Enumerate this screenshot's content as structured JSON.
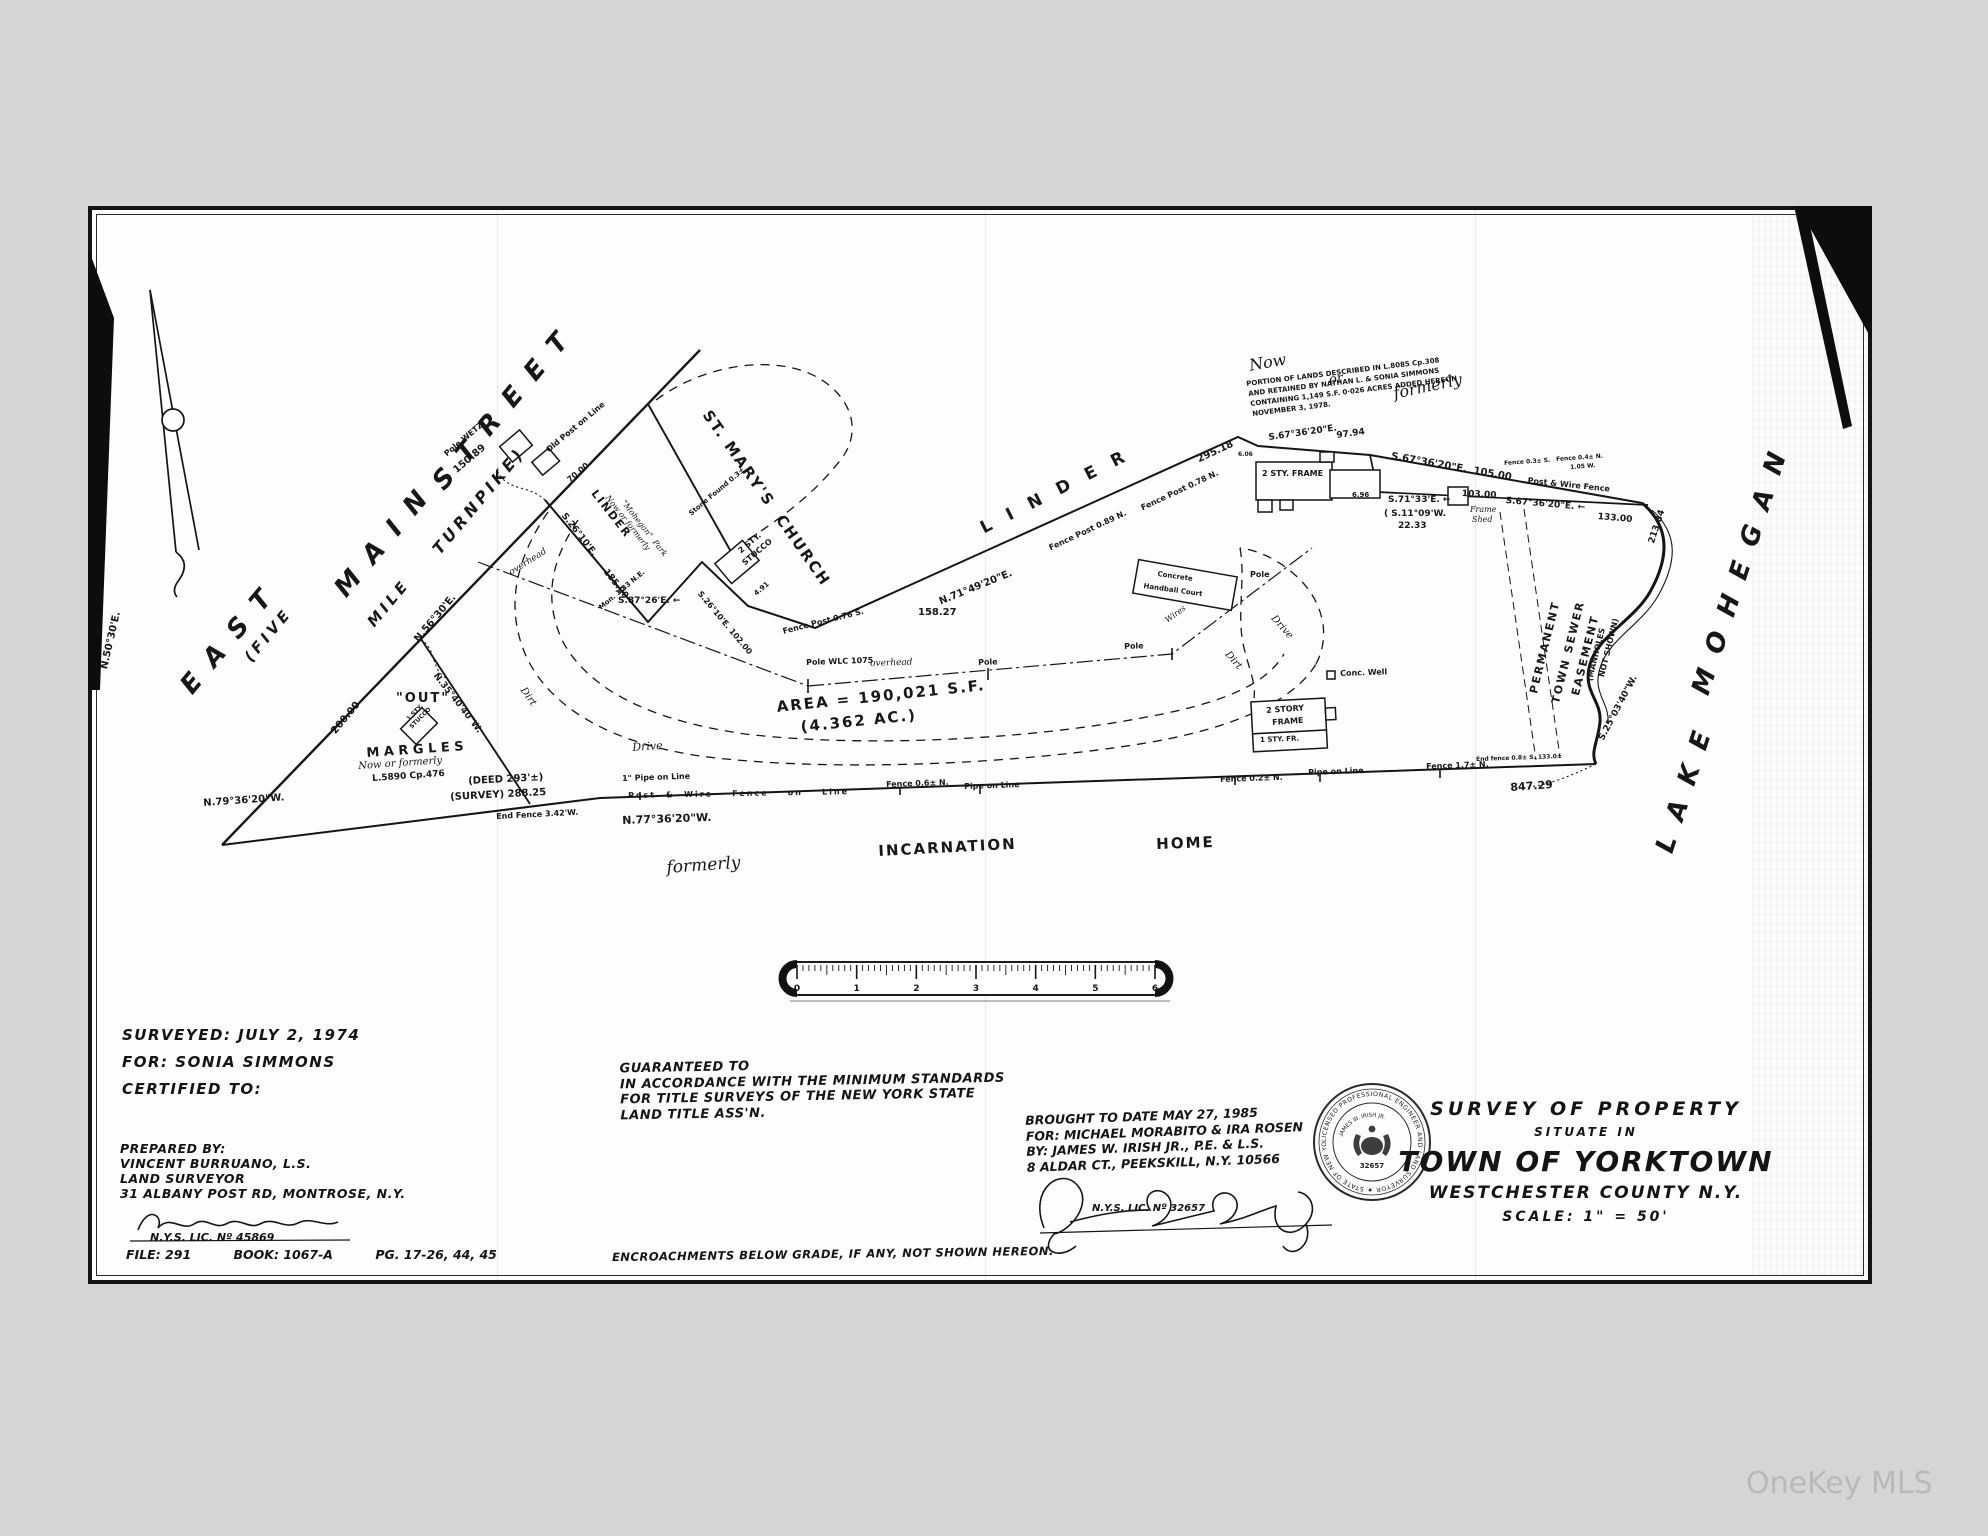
{
  "watermark": "OneKey MLS",
  "title_block": {
    "survey_of_property": "SURVEY OF PROPERTY",
    "situate_in": "SITUATE IN",
    "town": "TOWN OF YORKTOWN",
    "county": "WESTCHESTER COUNTY N.Y.",
    "scale": "SCALE: 1\" = 50'"
  },
  "surveyor_block": {
    "lines": [
      "SURVEYED:   JULY 2, 1974",
      "FOR:   SONIA SIMMONS",
      "CERTIFIED TO:"
    ],
    "prepared_lines": [
      "PREPARED BY:",
      "VINCENT BURRUANO, L.S.",
      "LAND   SURVEYOR",
      "31 ALBANY POST RD, MONTROSE, N.Y."
    ],
    "license": "N.Y.S. LIC. Nº 45869",
    "signature_name": "Vincent Burruano"
  },
  "file_block": {
    "file": "FILE: 291",
    "book": "BOOK: 1067-A",
    "pages": "PG. 17-26, 44, 45"
  },
  "guarantee_block": {
    "lines": [
      "GUARANTEED TO",
      "IN ACCORDANCE WITH THE MINIMUM STANDARDS",
      "FOR TITLE SURVEYS OF THE NEW YORK STATE",
      "LAND TITLE ASS'N."
    ]
  },
  "revision_block": {
    "lines": [
      "BROUGHT TO DATE  MAY 27, 1985",
      "FOR:  MICHAEL MORABITO & IRA ROSEN",
      "BY: JAMES W. IRISH JR., P.E. & L.S.",
      "8 ALDAR CT., PEEKSKILL, N.Y. 10566"
    ],
    "license": "N.Y.S. LIC. Nº 32657",
    "signature_name": "James W. Irish Jr."
  },
  "encroachment_note": "ENCROACHMENTS BELOW GRADE, IF ANY, NOT SHOWN HEREON.",
  "seal": {
    "ring_text": "LICENSED PROFESSIONAL ENGINEER AND LAND SURVEYOR ★ STATE OF NEW YORK ★",
    "name": "JAMES W. IRISH JR.",
    "number": "32657"
  },
  "ruler": {
    "numbers": [
      "0",
      "1",
      "2",
      "3",
      "4",
      "5",
      "6"
    ]
  },
  "map": {
    "area_label": "AREA = 190,021 S.F. (4.362 AC.)",
    "labels": [
      {
        "t": "E A S T",
        "x": 176,
        "y": 682,
        "r": -50,
        "s": 26,
        "cls": "bg"
      },
      {
        "t": "M A I N",
        "x": 330,
        "y": 585,
        "r": -50,
        "s": 26,
        "cls": "bg"
      },
      {
        "t": "S T R E E T",
        "x": 428,
        "y": 478,
        "r": -50,
        "s": 26,
        "cls": "bg"
      },
      {
        "t": "(FIVE",
        "x": 242,
        "y": 655,
        "r": -50,
        "s": 15,
        "cls": "bg"
      },
      {
        "t": "MILE",
        "x": 365,
        "y": 620,
        "r": -50,
        "s": 15,
        "cls": "bg"
      },
      {
        "t": "TURNPIKE)",
        "x": 430,
        "y": 547,
        "r": -50,
        "s": 16,
        "cls": "bg"
      },
      {
        "t": "N.50°30'E.",
        "x": 100,
        "y": 668,
        "r": -77,
        "s": 10
      },
      {
        "t": "200.00",
        "x": 330,
        "y": 730,
        "r": -50,
        "s": 10
      },
      {
        "t": "N.56°30'E.",
        "x": 413,
        "y": 638,
        "r": -50,
        "s": 10
      },
      {
        "t": "N.35°40'40\"W.",
        "x": 438,
        "y": 672,
        "r": 52,
        "s": 9
      },
      {
        "t": "Pole WETZ",
        "x": 443,
        "y": 452,
        "r": -40,
        "s": 8
      },
      {
        "t": "150.89",
        "x": 452,
        "y": 468,
        "r": -40,
        "s": 10
      },
      {
        "t": "Old Post on Line",
        "x": 545,
        "y": 448,
        "r": -40,
        "s": 8
      },
      {
        "t": "70.00",
        "x": 566,
        "y": 478,
        "r": -40,
        "s": 8
      },
      {
        "t": "ST. MARY'S  CHURCH",
        "x": 712,
        "y": 408,
        "r": 55,
        "s": 15,
        "cls": "sp"
      },
      {
        "t": "L  I  N  D  E  R",
        "x": 978,
        "y": 522,
        "r": -27,
        "s": 17,
        "cls": "sp"
      },
      {
        "t": "LINDER",
        "x": 598,
        "y": 488,
        "r": 52,
        "s": 11,
        "cls": "sp"
      },
      {
        "t": "Now or formerly",
        "x": 610,
        "y": 494,
        "r": 52,
        "s": 8,
        "cls": "it"
      },
      {
        "t": "\"Mohegan\"  Park",
        "x": 626,
        "y": 499,
        "r": 52,
        "s": 8,
        "cls": "it"
      },
      {
        "t": "S.26°10'E.",
        "x": 566,
        "y": 512,
        "r": 52,
        "s": 9
      },
      {
        "t": "185.00",
        "x": 608,
        "y": 568,
        "r": 52,
        "s": 9
      },
      {
        "t": "Mon. 1.33 N.E.",
        "x": 598,
        "y": 606,
        "r": -40,
        "s": 7
      },
      {
        "t": "S.87°26'E. ←",
        "x": 618,
        "y": 597,
        "r": 0,
        "s": 9
      },
      {
        "t": "Stone Found 0.3±",
        "x": 688,
        "y": 512,
        "r": -40,
        "s": 7
      },
      {
        "t": "2 STY.",
        "x": 737,
        "y": 549,
        "r": -40,
        "s": 8
      },
      {
        "t": "STUCCO",
        "x": 741,
        "y": 561,
        "r": -40,
        "s": 8
      },
      {
        "t": "4.91",
        "x": 753,
        "y": 592,
        "r": -40,
        "s": 7
      },
      {
        "t": "S.26°10'E. 102.00",
        "x": 702,
        "y": 590,
        "r": 50,
        "s": 8
      },
      {
        "t": "Fence Post 0.76 S.",
        "x": 782,
        "y": 628,
        "r": -14,
        "s": 8
      },
      {
        "t": "158.27",
        "x": 918,
        "y": 608,
        "r": 0,
        "s": 10
      },
      {
        "t": "N.71°49'20\"E.",
        "x": 938,
        "y": 598,
        "r": -22,
        "s": 10
      },
      {
        "t": "Fence Post 0.89 N.",
        "x": 1048,
        "y": 545,
        "r": -25,
        "s": 8
      },
      {
        "t": "Fence Post 0.78 N.",
        "x": 1140,
        "y": 505,
        "r": -25,
        "s": 8
      },
      {
        "t": "295.18",
        "x": 1196,
        "y": 456,
        "r": -25,
        "s": 10
      },
      {
        "t": "Now",
        "x": 1248,
        "y": 358,
        "r": -10,
        "s": 16,
        "cls": "it"
      },
      {
        "t": "or",
        "x": 1328,
        "y": 374,
        "r": -10,
        "s": 13,
        "cls": "it"
      },
      {
        "t": "formerly",
        "x": 1392,
        "y": 386,
        "r": -12,
        "s": 16,
        "cls": "it"
      },
      {
        "t": "PORTION OF LANDS DESCRIBED IN L.8085 Cp.308",
        "x": 1246,
        "y": 381,
        "r": -7,
        "s": 7
      },
      {
        "t": "AND RETAINED BY NATHAN L. & SONIA SIMMONS",
        "x": 1248,
        "y": 391,
        "r": -7,
        "s": 7
      },
      {
        "t": "CONTAINING 1,149 S.F. 0·026 ACRES ADDED HEREON",
        "x": 1250,
        "y": 401,
        "r": -7,
        "s": 7
      },
      {
        "t": "NOVEMBER 3, 1978.",
        "x": 1252,
        "y": 411,
        "r": -7,
        "s": 7
      },
      {
        "t": "S.67°36'20\"E.",
        "x": 1268,
        "y": 434,
        "r": -8,
        "s": 9
      },
      {
        "t": "97.94",
        "x": 1336,
        "y": 432,
        "r": -8,
        "s": 9
      },
      {
        "t": "6.06",
        "x": 1238,
        "y": 452,
        "r": 0,
        "s": 6
      },
      {
        "t": "S.67°36'20\"E.  105.00",
        "x": 1392,
        "y": 452,
        "r": 10,
        "s": 10
      },
      {
        "t": "2 STY. FRAME",
        "x": 1262,
        "y": 470,
        "r": 0,
        "s": 8
      },
      {
        "t": "6.96",
        "x": 1352,
        "y": 492,
        "r": 0,
        "s": 7
      },
      {
        "t": "S.71°33'E. ←",
        "x": 1388,
        "y": 496,
        "r": 0,
        "s": 9
      },
      {
        "t": "( S.11°09'W.",
        "x": 1384,
        "y": 510,
        "r": 0,
        "s": 9
      },
      {
        "t": "22.33",
        "x": 1398,
        "y": 522,
        "r": 0,
        "s": 9
      },
      {
        "t": "103.00",
        "x": 1462,
        "y": 490,
        "r": 3,
        "s": 9
      },
      {
        "t": "Frame",
        "x": 1470,
        "y": 506,
        "r": 0,
        "s": 8,
        "cls": "it"
      },
      {
        "t": "Shed",
        "x": 1472,
        "y": 516,
        "r": 0,
        "s": 8,
        "cls": "it"
      },
      {
        "t": "Fence 0.3± S.",
        "x": 1504,
        "y": 461,
        "r": -4,
        "s": 6
      },
      {
        "t": "Fence 0.4± N.",
        "x": 1556,
        "y": 457,
        "r": -4,
        "s": 6
      },
      {
        "t": "1.05 W.",
        "x": 1570,
        "y": 465,
        "r": -4,
        "s": 6
      },
      {
        "t": "Post & Wire Fence",
        "x": 1528,
        "y": 477,
        "r": 6,
        "s": 8
      },
      {
        "t": "S.67°36'20\"E. ←",
        "x": 1506,
        "y": 497,
        "r": 5,
        "s": 9
      },
      {
        "t": "133.00",
        "x": 1598,
        "y": 513,
        "r": 5,
        "s": 9
      },
      {
        "t": "213.84",
        "x": 1648,
        "y": 542,
        "r": -72,
        "s": 9
      },
      {
        "t": "S.25°03'40\"W.",
        "x": 1598,
        "y": 738,
        "r": -62,
        "s": 9
      },
      {
        "t": "PERMANENT",
        "x": 1528,
        "y": 692,
        "r": -76,
        "s": 11,
        "cls": "sp"
      },
      {
        "t": "TOWN SEWER",
        "x": 1550,
        "y": 702,
        "r": -76,
        "s": 11,
        "cls": "sp"
      },
      {
        "t": "EASEMENT",
        "x": 1570,
        "y": 694,
        "r": -76,
        "s": 11,
        "cls": "sp"
      },
      {
        "t": "(MANHOLES",
        "x": 1586,
        "y": 680,
        "r": -76,
        "s": 8
      },
      {
        "t": "NOT SHOWN)",
        "x": 1598,
        "y": 676,
        "r": -76,
        "s": 8
      },
      {
        "t": "L A K E",
        "x": 1652,
        "y": 848,
        "r": -72,
        "s": 26,
        "cls": "bg"
      },
      {
        "t": "M O H E G A N",
        "x": 1688,
        "y": 690,
        "r": -72,
        "s": 26,
        "cls": "bg"
      },
      {
        "t": "End fence 0.8± S. 133.0±",
        "x": 1476,
        "y": 757,
        "r": -2,
        "s": 6
      },
      {
        "t": "847.29",
        "x": 1510,
        "y": 782,
        "r": -4,
        "s": 11
      },
      {
        "t": "Fence 1.7± N.",
        "x": 1426,
        "y": 763,
        "r": -2,
        "s": 8
      },
      {
        "t": "Pipe on Line",
        "x": 1308,
        "y": 769,
        "r": -2,
        "s": 8
      },
      {
        "t": "Fence 0.2± N.",
        "x": 1220,
        "y": 776,
        "r": -2,
        "s": 8
      },
      {
        "t": "Pipe on Line",
        "x": 964,
        "y": 783,
        "r": -2,
        "s": 8
      },
      {
        "t": "Fence 0.6± N.",
        "x": 886,
        "y": 781,
        "r": -2,
        "s": 8
      },
      {
        "t": "1\" Pipe on Line",
        "x": 622,
        "y": 775,
        "r": -2,
        "s": 8
      },
      {
        "t": "Post  &  Wire    Fence    on    Line",
        "x": 628,
        "y": 792,
        "r": -1,
        "s": 8,
        "cls": "sp"
      },
      {
        "t": "N.77°36'20\"W.",
        "x": 622,
        "y": 815,
        "r": -2,
        "s": 11
      },
      {
        "t": "N.79°36'20\"W.",
        "x": 203,
        "y": 799,
        "r": -4,
        "s": 10
      },
      {
        "t": "(DEED 293'±)",
        "x": 468,
        "y": 777,
        "r": -3,
        "s": 10
      },
      {
        "t": "(SURVEY) 288.25",
        "x": 450,
        "y": 793,
        "r": -3,
        "s": 10
      },
      {
        "t": "End Fence 3.42'W.",
        "x": 496,
        "y": 813,
        "r": -3,
        "s": 8
      },
      {
        "t": "\"OUT\"",
        "x": 396,
        "y": 692,
        "r": 0,
        "s": 13,
        "cls": "sp"
      },
      {
        "t": "1 STY.",
        "x": 406,
        "y": 718,
        "r": -45,
        "s": 6
      },
      {
        "t": "STUCCO",
        "x": 409,
        "y": 726,
        "r": -45,
        "s": 6
      },
      {
        "t": "M A R G L E S",
        "x": 366,
        "y": 747,
        "r": -4,
        "s": 13
      },
      {
        "t": "Now or formerly",
        "x": 358,
        "y": 762,
        "r": -4,
        "s": 10,
        "cls": "it"
      },
      {
        "t": "L.5890 Cp.476",
        "x": 372,
        "y": 775,
        "r": -4,
        "s": 9
      },
      {
        "t": "Dirt",
        "x": 526,
        "y": 686,
        "r": 55,
        "s": 10,
        "cls": "it"
      },
      {
        "t": "Drive",
        "x": 632,
        "y": 742,
        "r": -4,
        "s": 11,
        "cls": "it"
      },
      {
        "t": "overhead",
        "x": 508,
        "y": 570,
        "r": -32,
        "s": 9,
        "cls": "it"
      },
      {
        "t": "overhead",
        "x": 870,
        "y": 660,
        "r": -2,
        "s": 9,
        "cls": "it"
      },
      {
        "t": "Pole WLC 1075",
        "x": 806,
        "y": 659,
        "r": -2,
        "s": 8
      },
      {
        "t": "Pole",
        "x": 978,
        "y": 659,
        "r": -2,
        "s": 8
      },
      {
        "t": "Pole",
        "x": 1124,
        "y": 643,
        "r": -2,
        "s": 8
      },
      {
        "t": "Pole",
        "x": 1250,
        "y": 571,
        "r": 0,
        "s": 8
      },
      {
        "t": "Wires",
        "x": 1164,
        "y": 618,
        "r": -36,
        "s": 8,
        "cls": "it"
      },
      {
        "t": "Dirt",
        "x": 1230,
        "y": 650,
        "r": 48,
        "s": 10,
        "cls": "it"
      },
      {
        "t": "Drive",
        "x": 1276,
        "y": 614,
        "r": 48,
        "s": 10,
        "cls": "it"
      },
      {
        "t": "Conc. Well",
        "x": 1340,
        "y": 670,
        "r": -2,
        "s": 8
      },
      {
        "t": "Concrete",
        "x": 1158,
        "y": 571,
        "r": 8,
        "s": 7
      },
      {
        "t": "Handball Court",
        "x": 1144,
        "y": 583,
        "r": 8,
        "s": 7
      },
      {
        "t": "2 STORY",
        "x": 1266,
        "y": 707,
        "r": -4,
        "s": 8
      },
      {
        "t": "FRAME",
        "x": 1272,
        "y": 719,
        "r": -4,
        "s": 8
      },
      {
        "t": "1 STY. FR.",
        "x": 1260,
        "y": 737,
        "r": -2,
        "s": 7
      },
      {
        "t": "AREA = 190,021 S.F.",
        "x": 776,
        "y": 700,
        "r": -6,
        "s": 15,
        "cls": "sp"
      },
      {
        "t": "(4.362 AC.)",
        "x": 800,
        "y": 720,
        "r": -6,
        "s": 15,
        "cls": "sp"
      },
      {
        "t": "formerly",
        "x": 666,
        "y": 860,
        "r": -4,
        "s": 17,
        "cls": "it"
      },
      {
        "t": "INCARNATION",
        "x": 878,
        "y": 844,
        "r": -3,
        "s": 15,
        "cls": "sp"
      },
      {
        "t": "HOME",
        "x": 1156,
        "y": 837,
        "r": -2,
        "s": 15,
        "cls": "sp"
      }
    ]
  }
}
